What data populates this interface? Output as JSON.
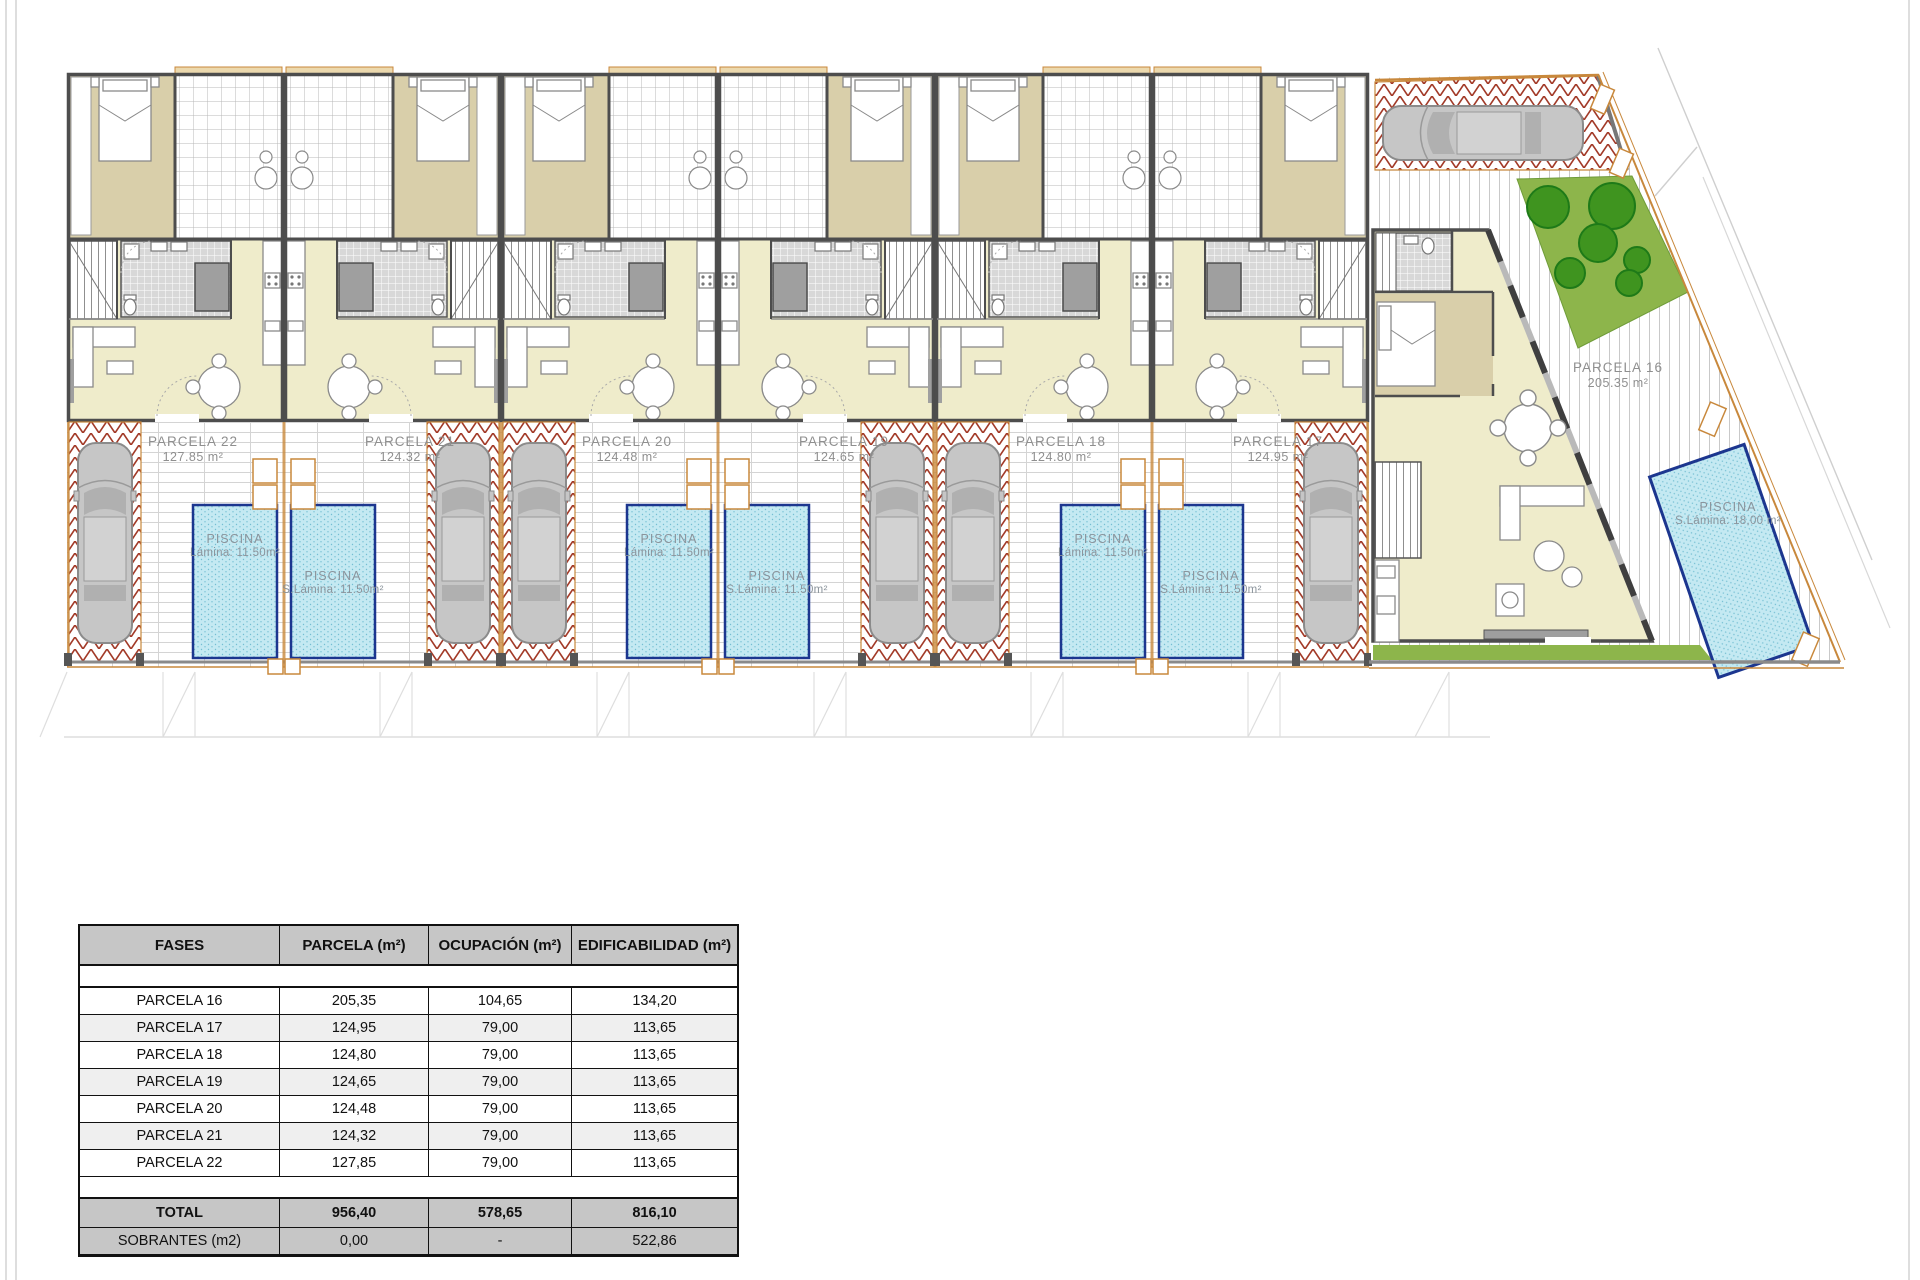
{
  "plan": {
    "parcels": [
      {
        "name": "PARCELA 22",
        "area": "127.85 m²",
        "pool_title": "PISCINA",
        "pool_area": "Lámina: 11.50m²"
      },
      {
        "name": "PARCELA 21",
        "area": "124.32 m²",
        "pool_title": "PISCINA",
        "pool_area": "S.Lámina: 11.50m²"
      },
      {
        "name": "PARCELA 20",
        "area": "124.48 m²",
        "pool_title": "PISCINA",
        "pool_area": "Lámina: 11.50m²"
      },
      {
        "name": "PARCELA 19",
        "area": "124.65 m²",
        "pool_title": "PISCINA",
        "pool_area": "S.Lámina: 11.50m²"
      },
      {
        "name": "PARCELA 18",
        "area": "124.80 m²",
        "pool_title": "PISCINA",
        "pool_area": "Lámina: 11.50m²"
      },
      {
        "name": "PARCELA 17",
        "area": "124.95 m²",
        "pool_title": "PISCINA",
        "pool_area": "S.Lámina: 11.50m²"
      },
      {
        "name": "PARCELA 16",
        "area": "205.35 m²",
        "pool_title": "PISCINA",
        "pool_area": "S.Lámina: 18,00 m²"
      }
    ]
  },
  "table": {
    "headers": [
      "FASES",
      "PARCELA (m²)",
      "OCUPACIÓN (m²)",
      "EDIFICABILIDAD (m²)"
    ],
    "rows": [
      {
        "label": "PARCELA 16",
        "parcela": "205,35",
        "ocupacion": "104,65",
        "edificabilidad": "134,20"
      },
      {
        "label": "PARCELA 17",
        "parcela": "124,95",
        "ocupacion": "79,00",
        "edificabilidad": "113,65"
      },
      {
        "label": "PARCELA 18",
        "parcela": "124,80",
        "ocupacion": "79,00",
        "edificabilidad": "113,65"
      },
      {
        "label": "PARCELA 19",
        "parcela": "124,65",
        "ocupacion": "79,00",
        "edificabilidad": "113,65"
      },
      {
        "label": "PARCELA 20",
        "parcela": "124,48",
        "ocupacion": "79,00",
        "edificabilidad": "113,65"
      },
      {
        "label": "PARCELA 21",
        "parcela": "124,32",
        "ocupacion": "79,00",
        "edificabilidad": "113,65"
      },
      {
        "label": "PARCELA 22",
        "parcela": "127,85",
        "ocupacion": "79,00",
        "edificabilidad": "113,65"
      }
    ],
    "total": {
      "label": "TOTAL",
      "parcela": "956,40",
      "ocupacion": "578,65",
      "edificabilidad": "816,10"
    },
    "sobrantes": {
      "label": "SOBRANTES (m2)",
      "parcela": "0,00",
      "ocupacion": "-",
      "edificabilidad": "522,86"
    }
  },
  "colors": {
    "pool_fill": "#c4e9f2",
    "pool_border": "#1c368f",
    "herringbone": "#a23a28",
    "garden_green": "#8db54b",
    "tree_green": "#3f941f",
    "fence_orange": "#c8883c",
    "wall_gray": "#4d4d4d",
    "bedroom_tan": "#d9cfaa",
    "living_pale": "#efeccb",
    "table_header_bg": "#c6c6c6"
  }
}
